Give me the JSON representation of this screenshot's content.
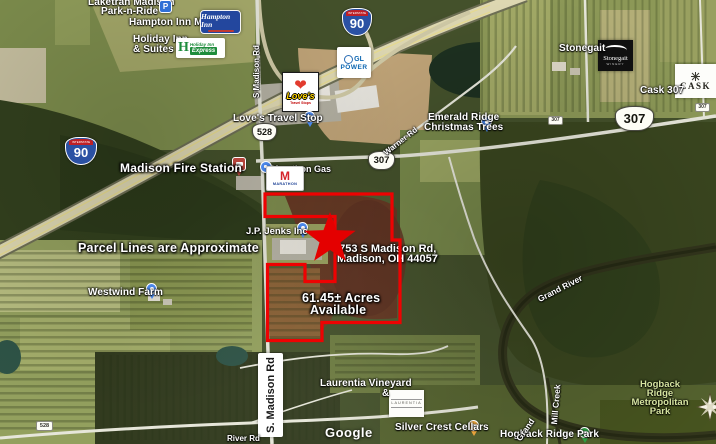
{
  "attribution": "Google",
  "annotations": {
    "fire_station": "Madison Fire Station",
    "parcel_note": "Parcel Lines are Approximate",
    "acreage_line1": "61.45± Acres",
    "acreage_line2": "Available",
    "address_line1": "7753 S Madison Rd,",
    "address_line2": "Madison, OH 44057",
    "accent_color": "#e80202"
  },
  "shields": {
    "interstate_caption": "INTERSTATE",
    "i90": "90",
    "r528": "528",
    "r307": "307"
  },
  "road_labels": {
    "s_madison_box": "S. Madison Rd",
    "s_madison_small": "S Madison Rd",
    "warner_rd": "Warner Rd",
    "river_rd": "River Rd",
    "grand_river": "Grand River",
    "grand": "Grand",
    "mill_creek": "Mill Creek"
  },
  "pois": {
    "laketran_line1": "Laketran Madison",
    "laketran_line2": "Park-n-Ride",
    "hampton": "Hampton Inn Madis",
    "holiday_line1": "Holiday Inn",
    "holiday_line2": "& Suites M",
    "loves": "Love's Travel Stop",
    "marathon": "Marathon Gas",
    "jenks": "J.P. Jenks Inc",
    "westwind": "Westwind Farm",
    "emerald_line1": "Emerald Ridge",
    "emerald_line2": "Christmas Trees",
    "stonegait": "Stonegait",
    "cask": "Cask 307",
    "laurentia_line1": "Laurentia Vineyard",
    "laurentia_line2": "&",
    "silver_crest": "Silver Crest Cellars",
    "hogback_park": "Hogback Ridge Park",
    "metro_line1": "Hogback",
    "metro_line2": "Ridge",
    "metro_line3": "Metropolitan",
    "metro_line4": "Park"
  },
  "logos": {
    "parking_p": "P",
    "hampton_text": "Hampton Inn",
    "holiday_h": "H",
    "holiday_name": "Holiday Inn",
    "holiday_express": "Express",
    "gl_initials": "GL",
    "gl_power": "POWER",
    "loves_name": "Love's",
    "loves_sub": "Travel Stops",
    "marathon_m": "M",
    "marathon_name": "MARATHON",
    "stonegait_name": "Stonegait",
    "stonegait_sub": "WINERY",
    "cask_name": "CASK",
    "laurentia_name": "LAURENTIA"
  }
}
